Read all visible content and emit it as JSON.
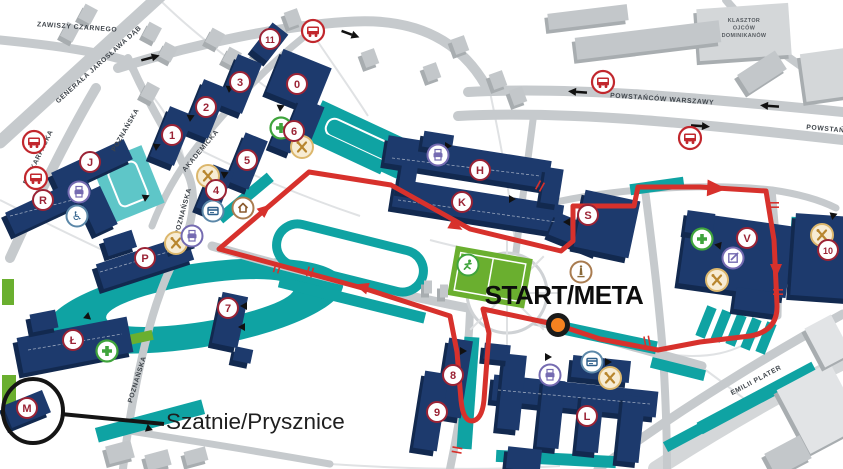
{
  "map": {
    "width": 843,
    "height": 469,
    "colors": {
      "building": "#1d3a6d",
      "building_side": "#12294f",
      "teal": "#0fa3a3",
      "teal_side": "#0b8081",
      "teal_light": "#5ec6c8",
      "gray_building": "#c3c7ca",
      "gray_side": "#a8adb0",
      "gray_light": "#d4d7d9",
      "gray_xlight": "#e2e4e6",
      "road": "#c6cacd",
      "minor_line": "#e0e2e4",
      "green": "#6aaf2f",
      "route": "#d7312c",
      "badge": "#9b2335",
      "bus_red": "#c1272d",
      "food_fill": "#f7ecd4",
      "food_ring": "#dcb76c",
      "food_glyph": "#b8862e",
      "purple": "#756bb1",
      "steel_blue": "#5b87a8",
      "health_green": "#3fa43c",
      "brown": "#a97c50",
      "marker_orange": "#f58220"
    },
    "labels": {
      "start_meta": {
        "text": "START/META"
      },
      "changing_rooms": {
        "text": "Szatnie/Prysznice"
      },
      "monastery": {
        "lines": [
          "KLASZTOR",
          "OJCÓW",
          "DOMINIKANÓW"
        ],
        "x": 744,
        "y": 22
      }
    },
    "streets": [
      {
        "label": "ZAWISZY CZARNEGO",
        "x": 77,
        "y": 29,
        "rot": 4
      },
      {
        "label": "GENERAŁA JAROSŁAWA DĄB",
        "x": 100,
        "y": 66,
        "rot": -42
      },
      {
        "label": "PODKARPACKA",
        "x": 40,
        "y": 158,
        "rot": -64
      },
      {
        "label": "POZNAŃSKA",
        "x": 127,
        "y": 131,
        "rot": -60
      },
      {
        "label": "POZNAŃSKA",
        "x": 185,
        "y": 212,
        "rot": -75
      },
      {
        "label": "POZNAŃSKA",
        "x": 139,
        "y": 380,
        "rot": -73
      },
      {
        "label": "AKADEMICKA",
        "x": 202,
        "y": 152,
        "rot": -50
      },
      {
        "label": "POWSTAŃCÓW WARSZAWY",
        "x": 662,
        "y": 101,
        "rot": 4
      },
      {
        "label": "POWSTAŃC",
        "x": 828,
        "y": 131,
        "rot": 5
      },
      {
        "label": "EMILII PLATER",
        "x": 757,
        "y": 382,
        "rot": -28
      }
    ],
    "badges": [
      {
        "label": "11",
        "x": 270,
        "y": 39
      },
      {
        "label": "0",
        "x": 297,
        "y": 84
      },
      {
        "label": "3",
        "x": 240,
        "y": 82
      },
      {
        "label": "2",
        "x": 206,
        "y": 107
      },
      {
        "label": "1",
        "x": 172,
        "y": 135
      },
      {
        "label": "6",
        "x": 294,
        "y": 131
      },
      {
        "label": "5",
        "x": 247,
        "y": 160
      },
      {
        "label": "4",
        "x": 216,
        "y": 190
      },
      {
        "label": "J",
        "x": 90,
        "y": 162
      },
      {
        "label": "R",
        "x": 43,
        "y": 200
      },
      {
        "label": "P",
        "x": 145,
        "y": 258
      },
      {
        "label": "7",
        "x": 228,
        "y": 308
      },
      {
        "label": "Ł",
        "x": 73,
        "y": 340
      },
      {
        "label": "M",
        "x": 27,
        "y": 408
      },
      {
        "label": "8",
        "x": 453,
        "y": 375
      },
      {
        "label": "9",
        "x": 437,
        "y": 412
      },
      {
        "label": "L",
        "x": 587,
        "y": 416
      },
      {
        "label": "H",
        "x": 480,
        "y": 170
      },
      {
        "label": "K",
        "x": 462,
        "y": 202
      },
      {
        "label": "S",
        "x": 588,
        "y": 215
      },
      {
        "label": "V",
        "x": 747,
        "y": 238
      },
      {
        "label": "10",
        "x": 828,
        "y": 250
      }
    ],
    "icons": [
      {
        "type": "bus-stop",
        "x": 34,
        "y": 142
      },
      {
        "type": "bus-stop",
        "x": 36,
        "y": 178
      },
      {
        "type": "bus-stop",
        "x": 313,
        "y": 31
      },
      {
        "type": "bus-stop",
        "x": 603,
        "y": 82
      },
      {
        "type": "bus-stop",
        "x": 690,
        "y": 138
      },
      {
        "type": "food",
        "x": 208,
        "y": 176
      },
      {
        "type": "food",
        "x": 302,
        "y": 147
      },
      {
        "type": "food",
        "x": 176,
        "y": 243
      },
      {
        "type": "food",
        "x": 717,
        "y": 280
      },
      {
        "type": "food",
        "x": 822,
        "y": 235
      },
      {
        "type": "food",
        "x": 610,
        "y": 378
      },
      {
        "type": "printing",
        "x": 79,
        "y": 192
      },
      {
        "type": "printing",
        "x": 192,
        "y": 236
      },
      {
        "type": "printing",
        "x": 438,
        "y": 155
      },
      {
        "type": "printing",
        "x": 550,
        "y": 375
      },
      {
        "type": "atm",
        "x": 213,
        "y": 211
      },
      {
        "type": "atm",
        "x": 592,
        "y": 362
      },
      {
        "type": "accessible",
        "x": 77,
        "y": 216
      },
      {
        "type": "health",
        "x": 281,
        "y": 128
      },
      {
        "type": "health",
        "x": 702,
        "y": 239
      },
      {
        "type": "health",
        "x": 107,
        "y": 351
      },
      {
        "type": "registry",
        "x": 733,
        "y": 258
      },
      {
        "type": "monument",
        "x": 581,
        "y": 272
      },
      {
        "type": "dormitory",
        "x": 243,
        "y": 208
      },
      {
        "type": "sports",
        "x": 468,
        "y": 265
      }
    ],
    "route": {
      "path": "M558,325 L483,309 L489,333 L484,400 Q482,420 472,421 Q463,421 461,400 L457,352 L450,316 L366,289 L282,266 L219,249 L309,172 L391,185 L470,229 L561,251 L573,241 L573,206 L634,206 L638,187 L700,187 L766,191 L774,240 L777,305 Q778,331 750,336 L700,342 L658,350 L600,339 Z",
      "arrows": [
        [
          366,
          288,
          197,
          1
        ],
        [
          262,
          212,
          -40,
          1
        ],
        [
          452,
          224,
          29,
          1
        ],
        [
          710,
          188,
          3,
          1.4
        ],
        [
          776,
          266,
          90,
          1
        ]
      ],
      "ticks": [
        [
          540,
          186,
          29
        ],
        [
          277,
          268,
          17
        ],
        [
          647,
          341,
          -10
        ],
        [
          774,
          205,
          90
        ],
        [
          778,
          292,
          90
        ],
        [
          457,
          450,
          100
        ],
        [
          310,
          272,
          15
        ]
      ]
    },
    "road_arrows": [
      [
        150,
        58,
        -15
      ],
      [
        350,
        34,
        20
      ],
      [
        578,
        92,
        184
      ],
      [
        770,
        106,
        184
      ],
      [
        700,
        126,
        4
      ]
    ],
    "marker": {
      "x": 558,
      "y": 325
    },
    "highlight": {
      "cx": 33,
      "cy": 411,
      "rx": 30,
      "ry": 32
    },
    "leader": {
      "x1": 61,
      "y1": 414,
      "x2": 164,
      "y2": 424
    }
  }
}
